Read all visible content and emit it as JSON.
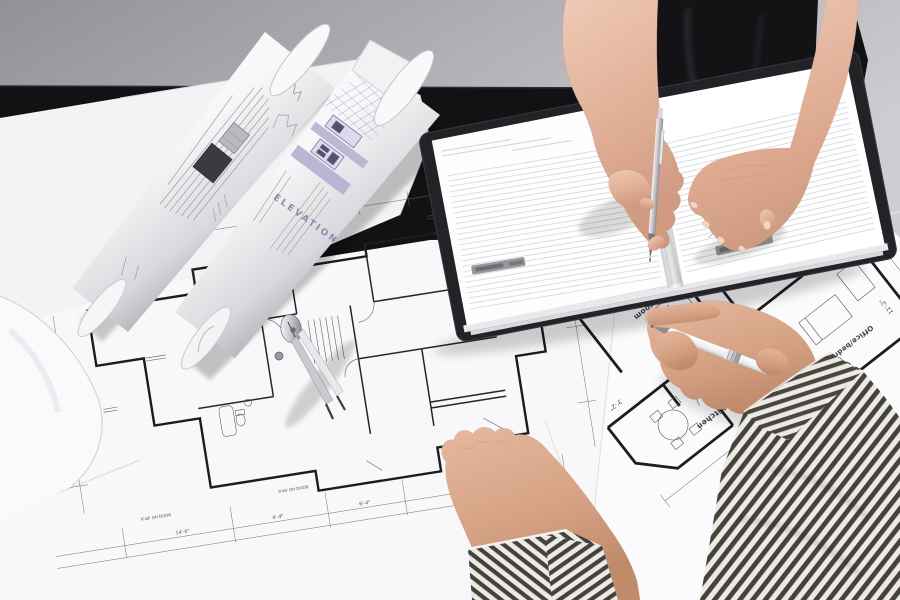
{
  "palette": {
    "wall": "#a9a8ac",
    "table": "#121214",
    "paper": "#f8f8fa",
    "blueprint_line": "#3a3a40",
    "lavender_accent": "#b3abce",
    "skin_woman": "#e2b49e",
    "skin_man": "#d5a184",
    "shirt_stripe_dark": "#45413b",
    "shirt_stripe_light": "#eceae5",
    "pen_silver": "#c6c6cc",
    "notebook_cover": "#232327"
  },
  "rolled_blueprints": {
    "elevation_label": "ELEVATION"
  },
  "right_floor_plan": {
    "room_labels": [
      "Dining room",
      "Kitchen",
      "Office/bedroom"
    ],
    "dimension_labels": [
      "10'-2\"",
      "3'-2\"",
      "11'-2\""
    ]
  },
  "center_floor_plan": {
    "dimension_labels": [
      "14'-0\"",
      "4'-4\"",
      "6'-4\"",
      "8'-4\""
    ],
    "annotations": [
      "9'x8' OH DOOR",
      "9'x8' OH DOOR"
    ]
  }
}
